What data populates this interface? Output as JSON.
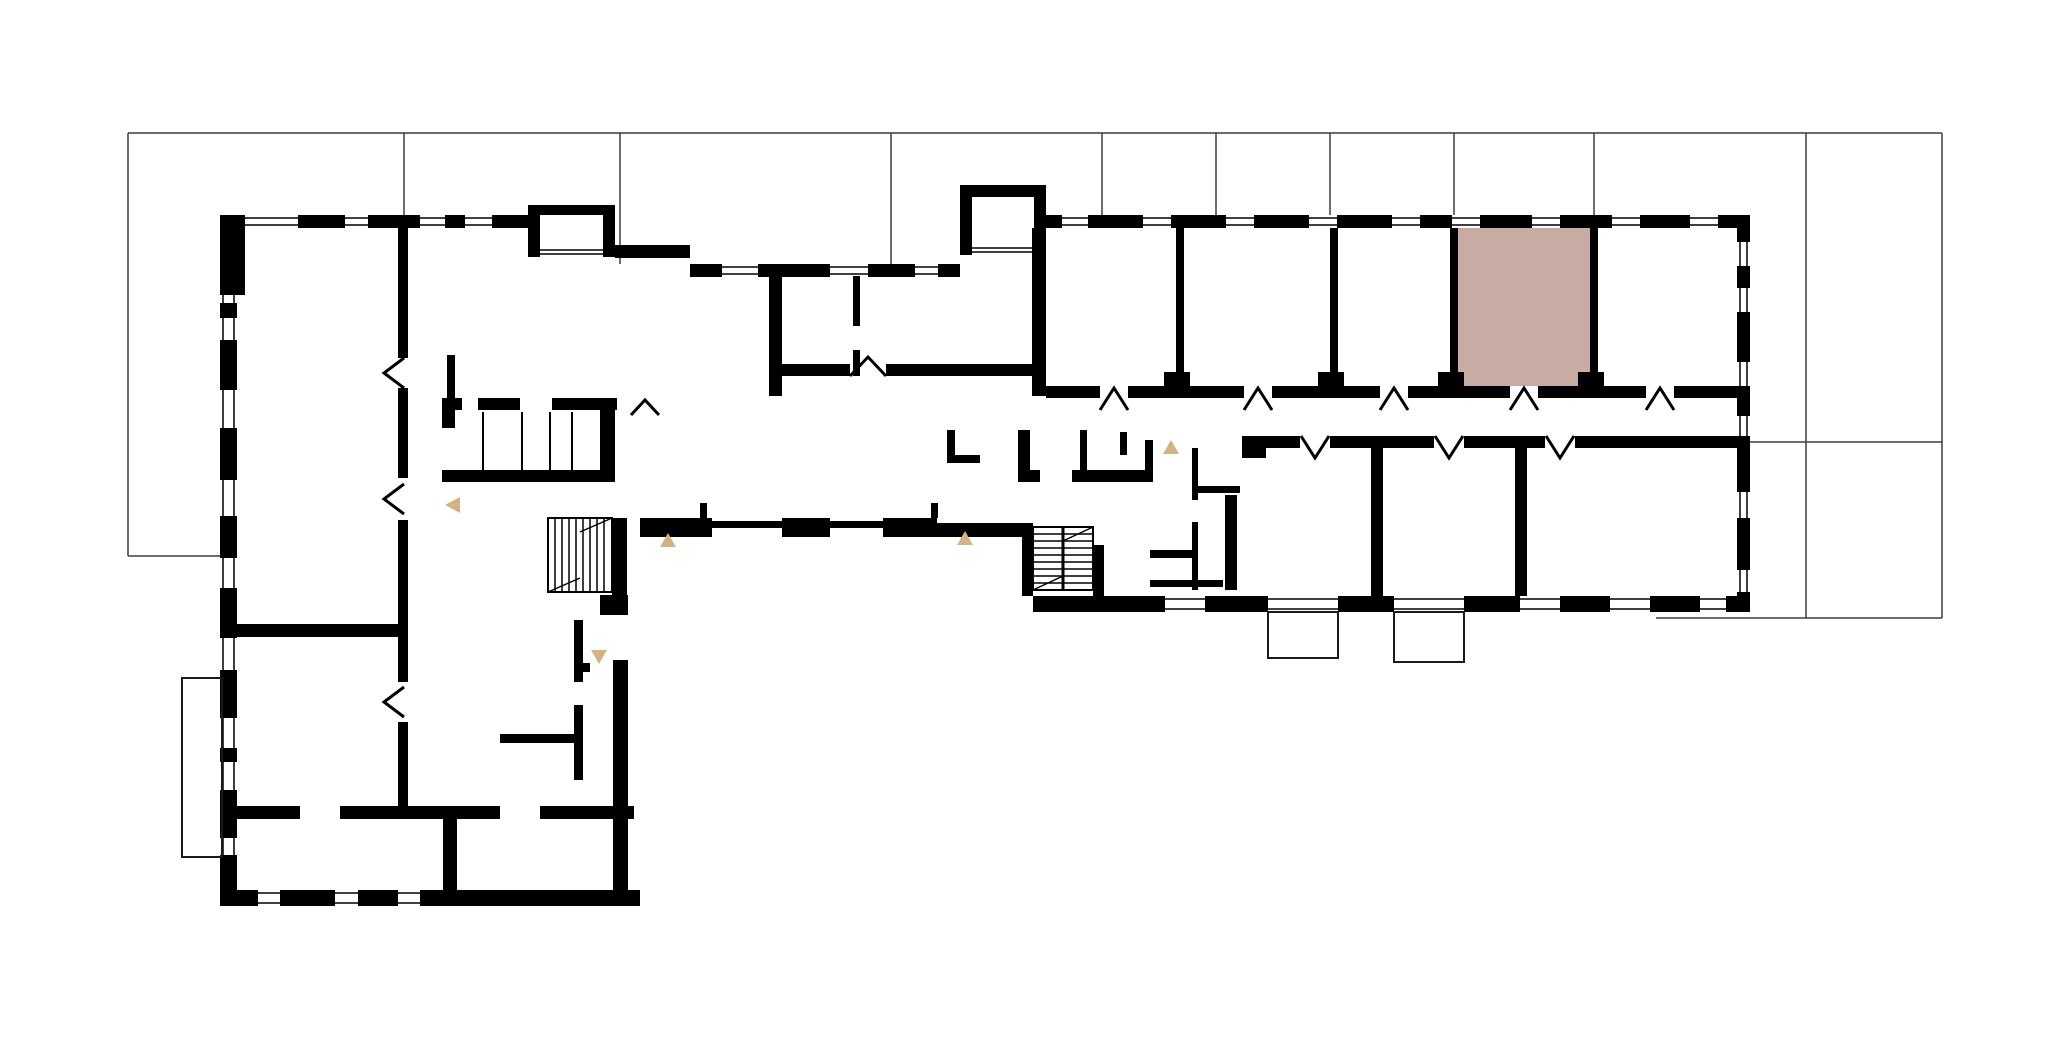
{
  "canvas": {
    "width": 2070,
    "height": 1052,
    "background_color": "#ffffff"
  },
  "colors": {
    "wall": "#000000",
    "grid_line": "#3d3d3d",
    "window_line": "#000000",
    "selected_unit_fill": "#c8aca3",
    "direction_marker": "#d2b286",
    "balcony_outline": "#1a1a1a"
  },
  "selected_unit": {
    "x": 1458,
    "y": 228,
    "w": 132,
    "h": 158
  },
  "grid_lines": [
    {
      "x1": 128,
      "y1": 133,
      "x2": 1942,
      "y2": 133
    },
    {
      "x1": 128,
      "y1": 133,
      "x2": 128,
      "y2": 556
    },
    {
      "x1": 128,
      "y1": 556,
      "x2": 222,
      "y2": 556
    },
    {
      "x1": 1942,
      "y1": 133,
      "x2": 1942,
      "y2": 618
    },
    {
      "x1": 1750,
      "y1": 442,
      "x2": 1942,
      "y2": 442
    },
    {
      "x1": 1656,
      "y1": 618,
      "x2": 1942,
      "y2": 618
    },
    {
      "x1": 1806,
      "y1": 133,
      "x2": 1806,
      "y2": 618
    },
    {
      "x1": 404,
      "y1": 133,
      "x2": 404,
      "y2": 215
    },
    {
      "x1": 620,
      "y1": 133,
      "x2": 620,
      "y2": 264
    },
    {
      "x1": 891,
      "y1": 133,
      "x2": 891,
      "y2": 264
    },
    {
      "x1": 1102,
      "y1": 133,
      "x2": 1102,
      "y2": 215
    },
    {
      "x1": 1216,
      "y1": 133,
      "x2": 1216,
      "y2": 215
    },
    {
      "x1": 1330,
      "y1": 133,
      "x2": 1330,
      "y2": 215
    },
    {
      "x1": 1454,
      "y1": 133,
      "x2": 1454,
      "y2": 215
    },
    {
      "x1": 1594,
      "y1": 133,
      "x2": 1594,
      "y2": 215
    }
  ],
  "window_walls": [
    {
      "o": "h",
      "x": 220,
      "y": 215,
      "len": 320,
      "t": 13,
      "dashes": [
        [
          220,
          245
        ],
        [
          298,
          345
        ],
        [
          368,
          420
        ],
        [
          445,
          465
        ],
        [
          492,
          540
        ]
      ]
    },
    {
      "o": "h",
      "x": 690,
      "y": 264,
      "len": 270,
      "t": 13,
      "dashes": [
        [
          690,
          722
        ],
        [
          758,
          830
        ],
        [
          868,
          915
        ],
        [
          938,
          960
        ]
      ]
    },
    {
      "o": "h",
      "x": 1034,
      "y": 215,
      "len": 716,
      "t": 13,
      "dashes": [
        [
          1034,
          1062
        ],
        [
          1088,
          1143
        ],
        [
          1171,
          1226
        ],
        [
          1254,
          1309
        ],
        [
          1337,
          1392
        ],
        [
          1420,
          1452
        ],
        [
          1480,
          1532
        ],
        [
          1560,
          1612
        ],
        [
          1640,
          1690
        ],
        [
          1718,
          1750
        ]
      ]
    },
    {
      "o": "v",
      "x": 1737,
      "y": 215,
      "len": 397,
      "t": 13,
      "dashes": [
        [
          215,
          242
        ],
        [
          266,
          288
        ],
        [
          312,
          362
        ],
        [
          390,
          416
        ],
        [
          440,
          492
        ],
        [
          518,
          570
        ],
        [
          592,
          612
        ]
      ]
    },
    {
      "o": "h",
      "x": 1033,
      "y": 596,
      "len": 717,
      "t": 16,
      "dashes": [
        [
          1033,
          1165
        ],
        [
          1205,
          1268
        ],
        [
          1338,
          1394
        ],
        [
          1464,
          1520
        ],
        [
          1560,
          1610
        ],
        [
          1650,
          1700
        ],
        [
          1726,
          1750
        ]
      ]
    },
    {
      "o": "v",
      "x": 220,
      "y": 295,
      "len": 595,
      "t": 17,
      "dashes": [
        [
          303,
          318
        ],
        [
          340,
          390
        ],
        [
          428,
          480
        ],
        [
          516,
          558
        ],
        [
          588,
          638
        ],
        [
          670,
          718
        ],
        [
          748,
          762
        ],
        [
          790,
          838
        ],
        [
          855,
          890
        ]
      ]
    },
    {
      "o": "h",
      "x": 220,
      "y": 890,
      "len": 420,
      "t": 16,
      "dashes": [
        [
          220,
          258
        ],
        [
          280,
          335
        ],
        [
          358,
          398
        ],
        [
          420,
          640
        ]
      ]
    }
  ],
  "solid_walls": [
    {
      "x": 220,
      "y": 228,
      "w": 25,
      "h": 67
    },
    {
      "x": 528,
      "y": 205,
      "w": 12,
      "h": 52
    },
    {
      "x": 528,
      "y": 205,
      "w": 87,
      "h": 10
    },
    {
      "x": 603,
      "y": 205,
      "w": 12,
      "h": 52
    },
    {
      "x": 615,
      "y": 245,
      "w": 75,
      "h": 13
    },
    {
      "x": 960,
      "y": 185,
      "w": 12,
      "h": 70
    },
    {
      "x": 960,
      "y": 185,
      "w": 86,
      "h": 12
    },
    {
      "x": 1034,
      "y": 185,
      "w": 12,
      "h": 43
    },
    {
      "x": 398,
      "y": 228,
      "w": 10,
      "h": 130
    },
    {
      "x": 398,
      "y": 388,
      "w": 10,
      "h": 90
    },
    {
      "x": 398,
      "y": 520,
      "w": 10,
      "h": 162
    },
    {
      "x": 398,
      "y": 722,
      "w": 10,
      "h": 90
    },
    {
      "x": 237,
      "y": 624,
      "w": 167,
      "h": 13
    },
    {
      "x": 237,
      "y": 806,
      "w": 63,
      "h": 13
    },
    {
      "x": 340,
      "y": 806,
      "w": 160,
      "h": 13
    },
    {
      "x": 540,
      "y": 806,
      "w": 94,
      "h": 13
    },
    {
      "x": 443,
      "y": 818,
      "w": 14,
      "h": 72
    },
    {
      "x": 574,
      "y": 620,
      "w": 9,
      "h": 62
    },
    {
      "x": 574,
      "y": 705,
      "w": 9,
      "h": 75
    },
    {
      "x": 574,
      "y": 663,
      "w": 16,
      "h": 9
    },
    {
      "x": 500,
      "y": 734,
      "w": 74,
      "h": 9
    },
    {
      "x": 612,
      "y": 518,
      "w": 15,
      "h": 77
    },
    {
      "x": 600,
      "y": 595,
      "w": 28,
      "h": 20
    },
    {
      "x": 613,
      "y": 660,
      "w": 15,
      "h": 230
    },
    {
      "x": 442,
      "y": 398,
      "w": 20,
      "h": 12
    },
    {
      "x": 478,
      "y": 398,
      "w": 42,
      "h": 12
    },
    {
      "x": 552,
      "y": 398,
      "w": 65,
      "h": 12
    },
    {
      "x": 442,
      "y": 398,
      "w": 13,
      "h": 30
    },
    {
      "x": 600,
      "y": 398,
      "w": 15,
      "h": 84
    },
    {
      "x": 442,
      "y": 470,
      "w": 173,
      "h": 12
    },
    {
      "x": 447,
      "y": 355,
      "w": 8,
      "h": 45
    },
    {
      "x": 769,
      "y": 264,
      "w": 13,
      "h": 132
    },
    {
      "x": 782,
      "y": 364,
      "w": 68,
      "h": 12
    },
    {
      "x": 886,
      "y": 364,
      "w": 146,
      "h": 12
    },
    {
      "x": 853,
      "y": 276,
      "w": 7,
      "h": 50
    },
    {
      "x": 853,
      "y": 350,
      "w": 7,
      "h": 26
    },
    {
      "x": 947,
      "y": 430,
      "w": 8,
      "h": 32
    },
    {
      "x": 947,
      "y": 455,
      "w": 33,
      "h": 8
    },
    {
      "x": 640,
      "y": 518,
      "w": 53,
      "h": 19
    },
    {
      "x": 693,
      "y": 518,
      "w": 19,
      "h": 19
    },
    {
      "x": 712,
      "y": 521,
      "w": 70,
      "h": 7
    },
    {
      "x": 700,
      "y": 503,
      "w": 7,
      "h": 15
    },
    {
      "x": 782,
      "y": 518,
      "w": 31,
      "h": 19
    },
    {
      "x": 813,
      "y": 518,
      "w": 17,
      "h": 19
    },
    {
      "x": 830,
      "y": 521,
      "w": 53,
      "h": 7
    },
    {
      "x": 883,
      "y": 518,
      "w": 54,
      "h": 19
    },
    {
      "x": 931,
      "y": 503,
      "w": 7,
      "h": 15
    },
    {
      "x": 937,
      "y": 523,
      "w": 96,
      "h": 14
    },
    {
      "x": 1032,
      "y": 228,
      "w": 14,
      "h": 168
    },
    {
      "x": 1022,
      "y": 527,
      "w": 11,
      "h": 69
    },
    {
      "x": 1093,
      "y": 545,
      "w": 11,
      "h": 51
    },
    {
      "x": 1046,
      "y": 386,
      "w": 54,
      "h": 12
    },
    {
      "x": 1128,
      "y": 386,
      "w": 116,
      "h": 12
    },
    {
      "x": 1272,
      "y": 386,
      "w": 108,
      "h": 12
    },
    {
      "x": 1408,
      "y": 386,
      "w": 102,
      "h": 12
    },
    {
      "x": 1538,
      "y": 386,
      "w": 108,
      "h": 12
    },
    {
      "x": 1674,
      "y": 386,
      "w": 76,
      "h": 12
    },
    {
      "x": 1176,
      "y": 228,
      "w": 8,
      "h": 158
    },
    {
      "x": 1330,
      "y": 228,
      "w": 8,
      "h": 158
    },
    {
      "x": 1450,
      "y": 228,
      "w": 8,
      "h": 158
    },
    {
      "x": 1590,
      "y": 228,
      "w": 8,
      "h": 158
    },
    {
      "x": 1164,
      "y": 372,
      "w": 26,
      "h": 14
    },
    {
      "x": 1318,
      "y": 372,
      "w": 26,
      "h": 14
    },
    {
      "x": 1438,
      "y": 372,
      "w": 26,
      "h": 14
    },
    {
      "x": 1578,
      "y": 372,
      "w": 26,
      "h": 14
    },
    {
      "x": 1243,
      "y": 436,
      "w": 57,
      "h": 12
    },
    {
      "x": 1330,
      "y": 436,
      "w": 104,
      "h": 12
    },
    {
      "x": 1464,
      "y": 436,
      "w": 81,
      "h": 12
    },
    {
      "x": 1575,
      "y": 436,
      "w": 175,
      "h": 12
    },
    {
      "x": 1371,
      "y": 443,
      "w": 12,
      "h": 153
    },
    {
      "x": 1515,
      "y": 448,
      "w": 12,
      "h": 148
    },
    {
      "x": 1018,
      "y": 430,
      "w": 12,
      "h": 50
    },
    {
      "x": 1018,
      "y": 470,
      "w": 22,
      "h": 12
    },
    {
      "x": 1072,
      "y": 470,
      "w": 81,
      "h": 12
    },
    {
      "x": 1080,
      "y": 430,
      "w": 7,
      "h": 40
    },
    {
      "x": 1120,
      "y": 432,
      "w": 7,
      "h": 23
    },
    {
      "x": 1145,
      "y": 440,
      "w": 8,
      "h": 40
    },
    {
      "x": 1192,
      "y": 448,
      "w": 6,
      "h": 52
    },
    {
      "x": 1192,
      "y": 522,
      "w": 6,
      "h": 68
    },
    {
      "x": 1192,
      "y": 486,
      "w": 48,
      "h": 7
    },
    {
      "x": 1242,
      "y": 436,
      "w": 24,
      "h": 22
    },
    {
      "x": 1225,
      "y": 495,
      "w": 12,
      "h": 95
    },
    {
      "x": 1150,
      "y": 550,
      "w": 47,
      "h": 8
    },
    {
      "x": 1150,
      "y": 580,
      "w": 73,
      "h": 7
    }
  ],
  "sill_lines": [
    {
      "x1": 540,
      "y1": 250,
      "x2": 603,
      "y2": 250
    },
    {
      "x1": 540,
      "y1": 254,
      "x2": 603,
      "y2": 254
    },
    {
      "x1": 972,
      "y1": 248,
      "x2": 1034,
      "y2": 248
    },
    {
      "x1": 972,
      "y1": 252,
      "x2": 1034,
      "y2": 252
    }
  ],
  "compartment_lines": [
    {
      "x1": 483,
      "y1": 412,
      "x2": 483,
      "y2": 470
    },
    {
      "x1": 522,
      "y1": 412,
      "x2": 522,
      "y2": 470
    },
    {
      "x1": 550,
      "y1": 412,
      "x2": 550,
      "y2": 470
    },
    {
      "x1": 572,
      "y1": 412,
      "x2": 572,
      "y2": 470
    }
  ],
  "balconies": [
    {
      "x": 1268,
      "y": 612,
      "w": 70,
      "h": 46
    },
    {
      "x": 1394,
      "y": 612,
      "w": 70,
      "h": 50
    },
    {
      "x": 182,
      "y": 678,
      "w": 40,
      "h": 179
    }
  ],
  "stairs": [
    {
      "x": 548,
      "y": 518,
      "w": 64,
      "h": 74,
      "treads": "v",
      "divider": false,
      "diag": true
    },
    {
      "x": 1033,
      "y": 527,
      "w": 60,
      "h": 63,
      "treads": "h",
      "divider": true,
      "diag": true
    }
  ],
  "door_chevrons": [
    {
      "pts": "404,358 384,373 404,388"
    },
    {
      "pts": "404,484 384,499 404,514"
    },
    {
      "pts": "404,687 384,702 404,717"
    },
    {
      "pts": "850,376 868,357 886,376"
    },
    {
      "pts": "631,415 645,400 659,415"
    },
    {
      "pts": "1100,410 1114,388 1128,410"
    },
    {
      "pts": "1244,410 1258,388 1272,410"
    },
    {
      "pts": "1380,410 1394,388 1408,410"
    },
    {
      "pts": "1510,410 1524,388 1538,410"
    },
    {
      "pts": "1646,410 1660,388 1674,410"
    },
    {
      "pts": "1301,436 1315,458 1329,436"
    },
    {
      "pts": "1435,436 1449,458 1463,436"
    },
    {
      "pts": "1546,436 1560,458 1574,436"
    }
  ],
  "direction_markers": [
    {
      "dir": "left",
      "pts": "460,497 445,505 460,513"
    },
    {
      "dir": "up",
      "pts": "668,533 660,547 676,547"
    },
    {
      "dir": "up",
      "pts": "965,531 957,545 973,545"
    },
    {
      "dir": "up",
      "pts": "1171,440 1163,454 1179,454"
    },
    {
      "dir": "down",
      "pts": "591,650 607,650 599,664"
    }
  ]
}
